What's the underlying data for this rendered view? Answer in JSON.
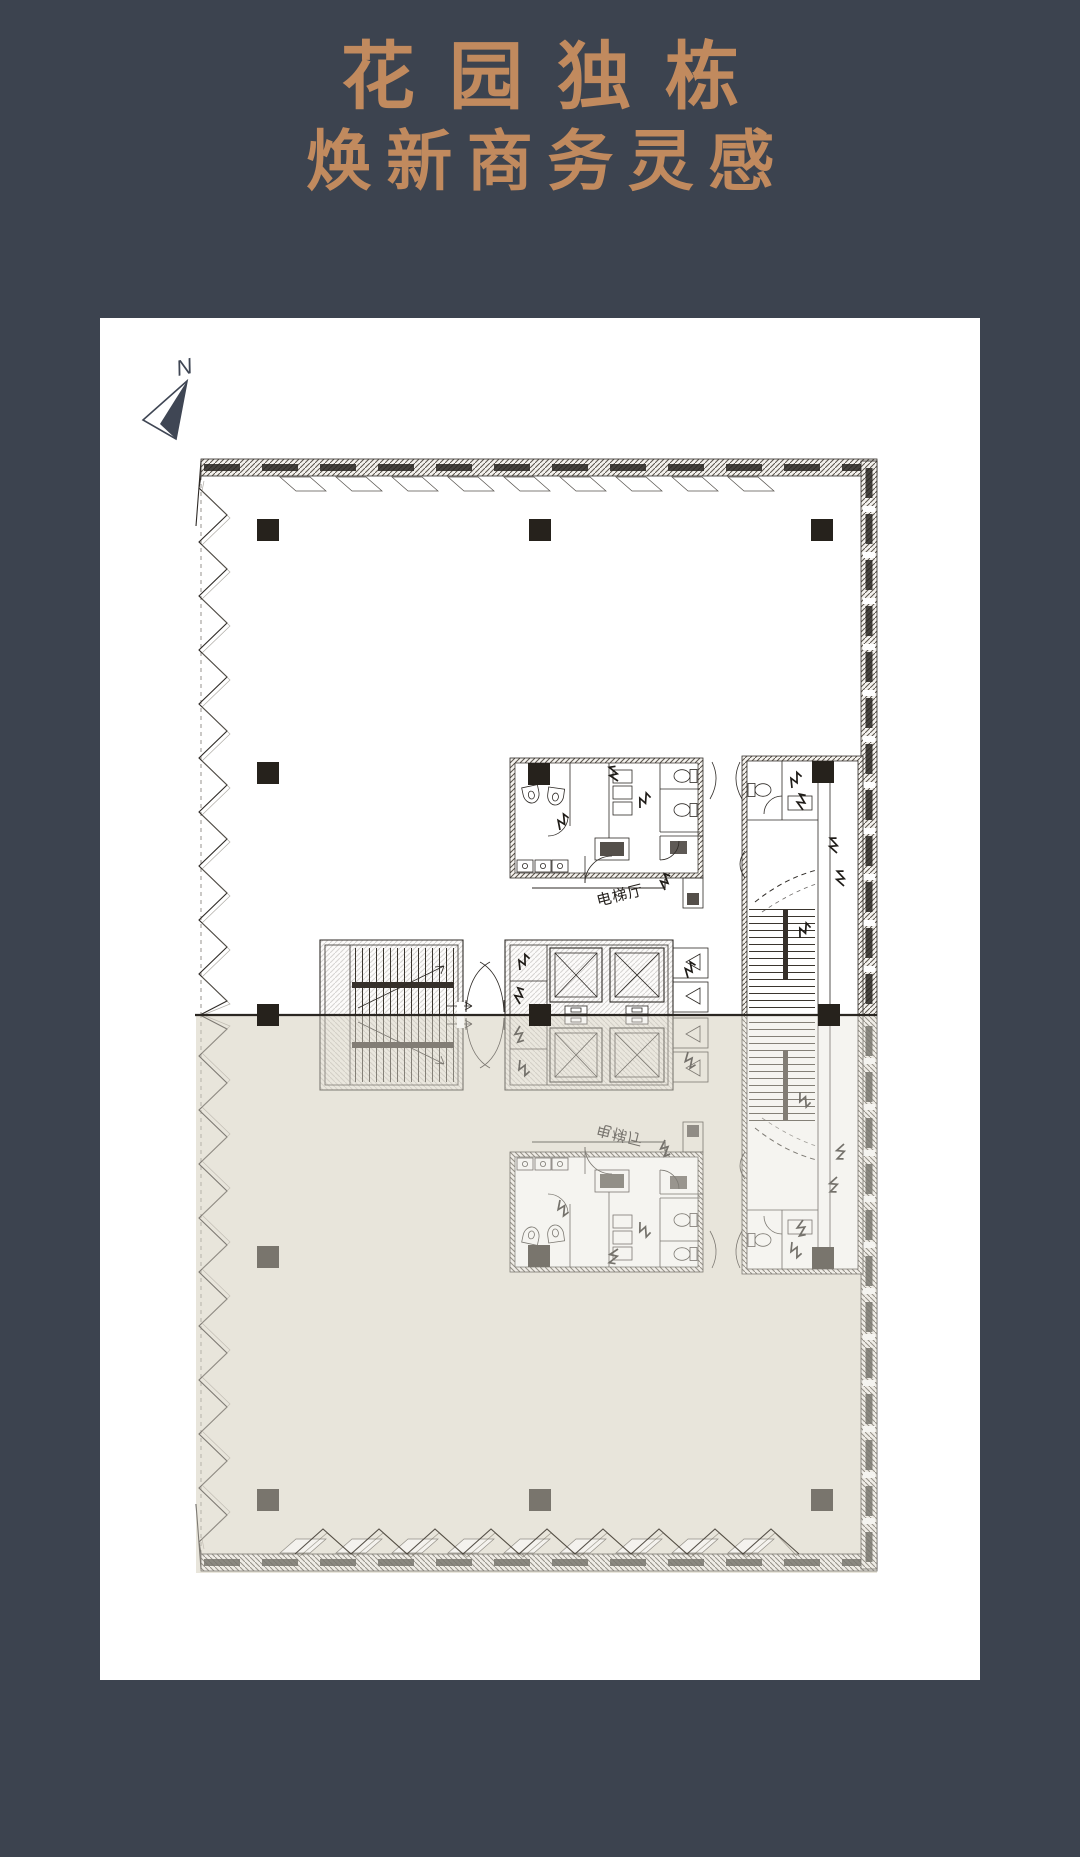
{
  "page": {
    "background_color": "#3c434f"
  },
  "header": {
    "title_line1": "花园独栋",
    "title_line2": "焕新商务灵感",
    "title_color": "#c18a5e"
  },
  "floor_plan": {
    "compass_label": "N",
    "labels": {
      "elevator_hall": "电梯厅"
    },
    "colors": {
      "card_background": "#ffffff",
      "shaded_reflection_zone": "#e9e5dc",
      "drawing_line": "#2e2a26",
      "column_fill": "#26221c",
      "compass": "#3f4654"
    }
  }
}
